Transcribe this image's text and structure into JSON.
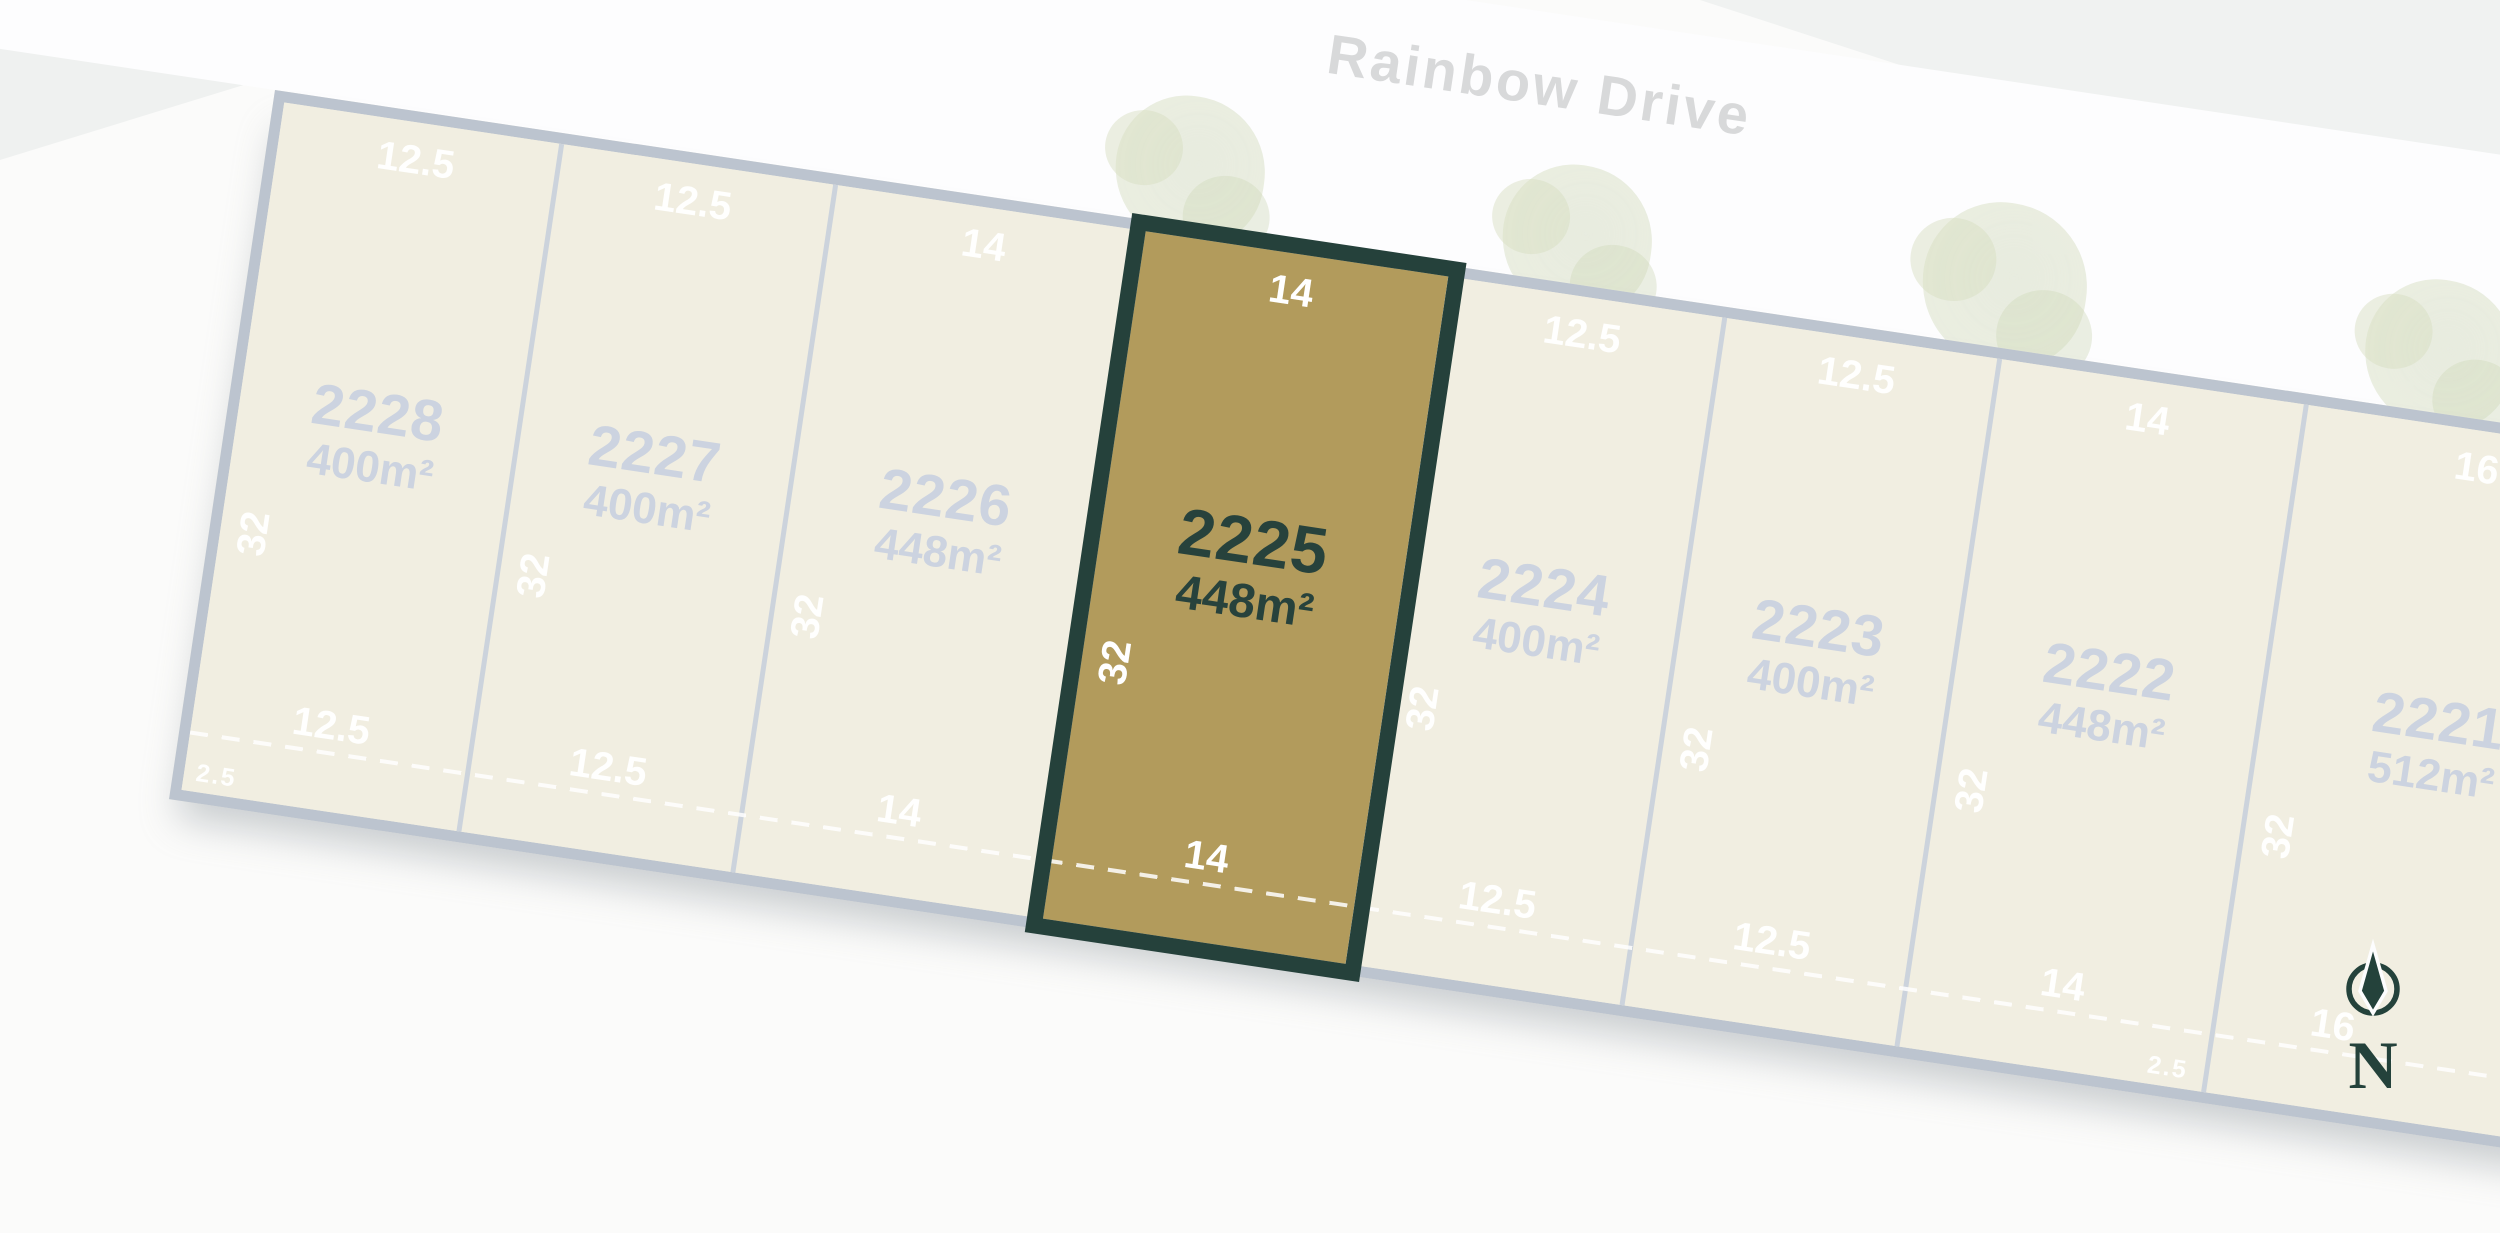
{
  "street": {
    "name": "Rainbow Drive"
  },
  "compass": {
    "label": "N"
  },
  "easement_label": "2.5",
  "highlighted_lot": "2225",
  "lots": [
    {
      "id": "2228",
      "area": "400m²",
      "frontage": "12.5",
      "depth": "32",
      "rear": "12.5",
      "width_m": 12.5,
      "highlighted": false
    },
    {
      "id": "2227",
      "area": "400m²",
      "frontage": "12.5",
      "depth": "32",
      "rear": "12.5",
      "width_m": 12.5,
      "highlighted": false
    },
    {
      "id": "2226",
      "area": "448m²",
      "frontage": "14",
      "depth": "32",
      "rear": "14",
      "width_m": 14,
      "highlighted": false
    },
    {
      "id": "2225",
      "area": "448m²",
      "frontage": "14",
      "depth": "32",
      "rear": "14",
      "width_m": 14,
      "highlighted": true
    },
    {
      "id": "2224",
      "area": "400m²",
      "frontage": "12.5",
      "depth": "32",
      "rear": "12.5",
      "width_m": 12.5,
      "highlighted": false
    },
    {
      "id": "2223",
      "area": "400m²",
      "frontage": "12.5",
      "depth": "32",
      "rear": "12.5",
      "width_m": 12.5,
      "highlighted": false
    },
    {
      "id": "2222",
      "area": "448m²",
      "frontage": "14",
      "depth": "32",
      "rear": "14",
      "width_m": 14,
      "highlighted": false
    },
    {
      "id": "2221",
      "area": "512m²",
      "frontage": "16",
      "depth": "32",
      "rear": "16",
      "width_m": 16,
      "highlighted": false
    }
  ],
  "colors": {
    "highlight_fill": "#b29b5c",
    "highlight_border": "#25413b",
    "highlight_text": "#27423c",
    "lot_fill": "#f1eee1",
    "lot_border": "#bcc4cf",
    "lot_divider": "#ccd3dc",
    "lot_text": "#ccd3e0",
    "dimension_text": "#ffffff",
    "street_text": "#d8d9da",
    "tree": "#ced7b4",
    "road": "#fdfdfe"
  }
}
